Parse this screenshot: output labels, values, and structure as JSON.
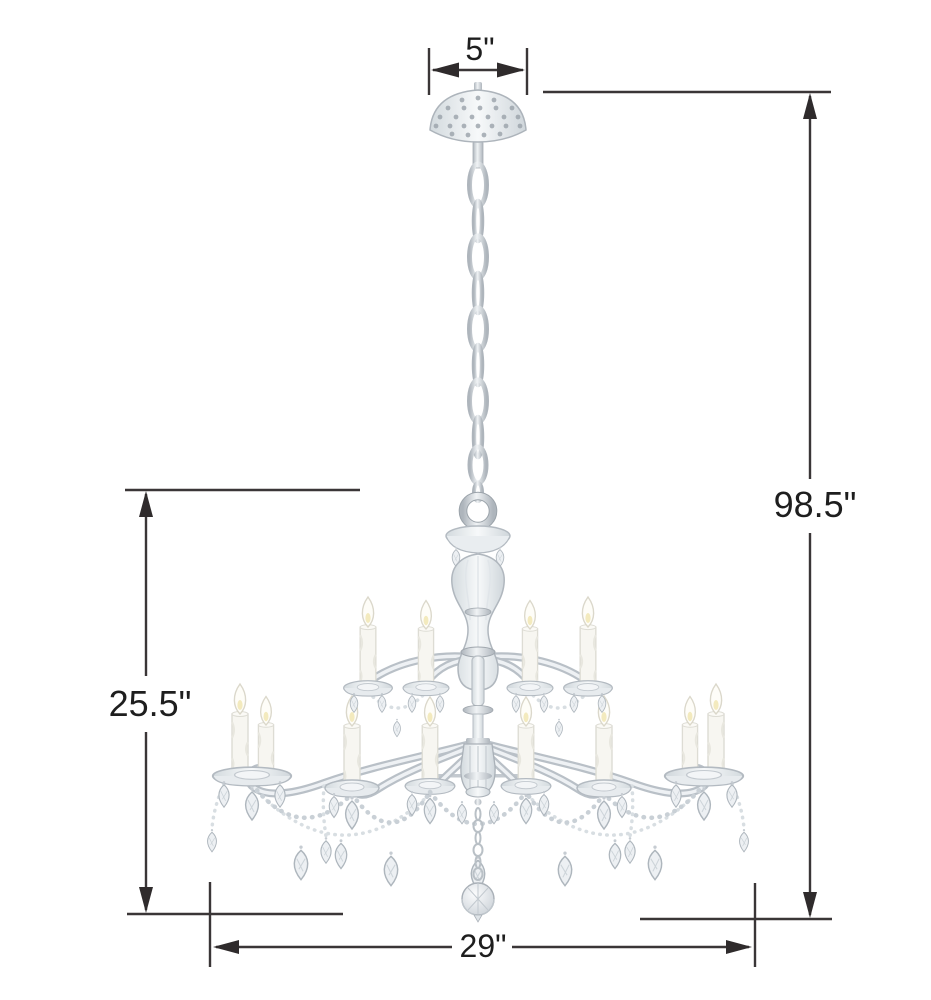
{
  "subject": "twelve-light crystal chandelier with chrome chain and crystal-studded canopy",
  "labels": {
    "canopy_width": "5\"",
    "overall_height": "98.5\"",
    "fixture_height": "25.5\"",
    "fixture_width": "29\""
  },
  "colors": {
    "background": "#ffffff",
    "dimension_lines": "#3a3637",
    "arrowheads": "#2f2b2c",
    "label_text": "#1e1e1e",
    "chrome_metal": "#c8ced4",
    "crystal_glass": "#eef1f4",
    "candle_white": "#f7f6f1"
  }
}
